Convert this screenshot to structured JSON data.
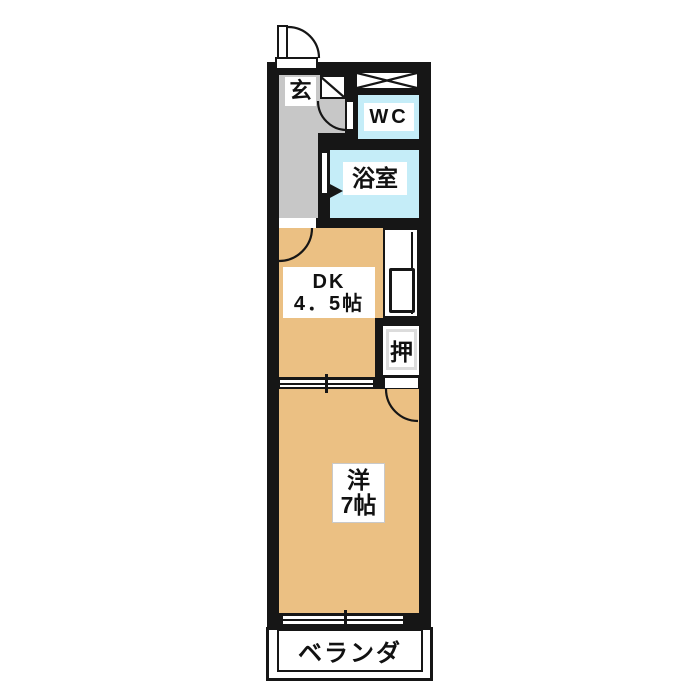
{
  "floorplan": {
    "type": "japanese-apartment-floor-plan",
    "rooms": {
      "genkan": {
        "label": "玄"
      },
      "wc": {
        "label": "WC"
      },
      "bath": {
        "label": "浴室"
      },
      "dk": {
        "label_line1": "DK",
        "label_line2": "4．5帖"
      },
      "closet": {
        "label": "押"
      },
      "western_room": {
        "label_line1": "洋",
        "label_line2": "7帖"
      },
      "veranda": {
        "label": "ベランダ"
      }
    },
    "colors": {
      "wall": "#161616",
      "room_tan": "#ebc083",
      "room_cyan": "#c5edf8",
      "corridor_gray": "#c7c7c7",
      "background": "#ffffff"
    }
  }
}
